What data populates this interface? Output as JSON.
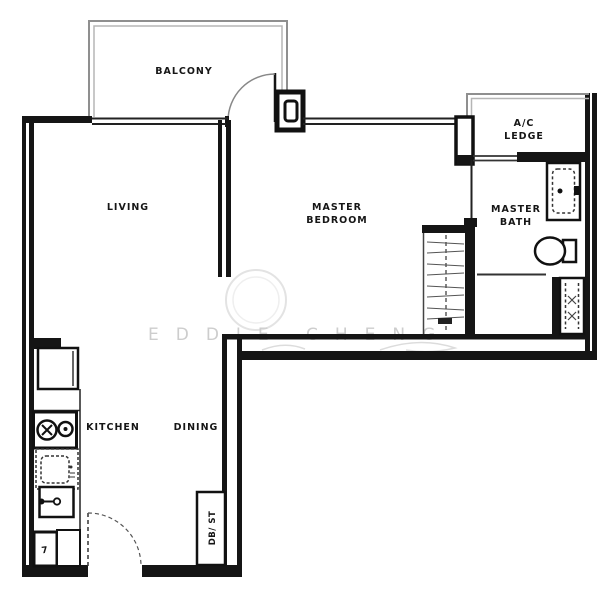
{
  "plan": {
    "rooms": {
      "balcony": "BALCONY",
      "living": "LIVING",
      "master_bedroom": [
        "MASTER",
        "BEDROOM"
      ],
      "ac_ledge": [
        "A/C",
        "LEDGE"
      ],
      "master_bath": [
        "MASTER",
        "BATH"
      ],
      "kitchen": "KITCHEN",
      "dining": "DINING",
      "db_st": "DB/ ST"
    },
    "fixtures": {
      "heater_box_glyph": "7"
    },
    "watermark": {
      "first_name": "EDDIE",
      "last_name": "CHENG"
    },
    "colors": {
      "wall": "#151515",
      "thin_wall": "#8f8f8f",
      "fixture_line": "#333333",
      "watermark": "#cdcdcd",
      "background": "#ffffff"
    }
  }
}
